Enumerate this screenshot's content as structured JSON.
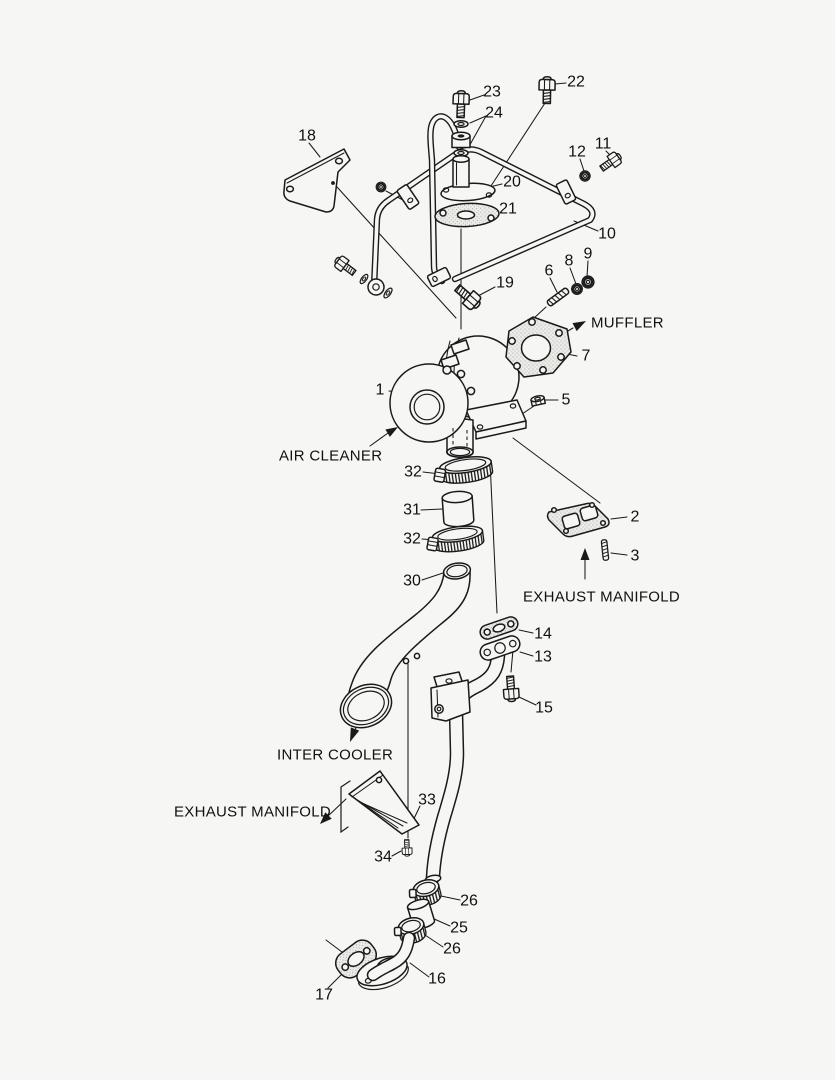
{
  "scene": {
    "background": "#f6f6f5",
    "ink": "#1a1a1a",
    "description": "Exploded parts diagram of a turbocharger with oil lines, intercooler pipe and oil drain piping"
  },
  "callouts": [
    {
      "part": "23",
      "x": 492,
      "y": 92
    },
    {
      "part": "22",
      "x": 576,
      "y": 82
    },
    {
      "part": "24",
      "x": 494,
      "y": 113
    },
    {
      "part": "18",
      "x": 307,
      "y": 136
    },
    {
      "part": "11",
      "x": 603,
      "y": 144
    },
    {
      "part": "12",
      "x": 577,
      "y": 152
    },
    {
      "part": "20",
      "x": 512,
      "y": 182
    },
    {
      "part": "21",
      "x": 508,
      "y": 209
    },
    {
      "part": "10",
      "x": 607,
      "y": 234
    },
    {
      "part": "9",
      "x": 588,
      "y": 254
    },
    {
      "part": "8",
      "x": 569,
      "y": 261
    },
    {
      "part": "6",
      "x": 549,
      "y": 271
    },
    {
      "part": "19",
      "x": 505,
      "y": 283
    },
    {
      "part": "7",
      "x": 586,
      "y": 356
    },
    {
      "part": "1",
      "x": 380,
      "y": 390
    },
    {
      "part": "5",
      "x": 566,
      "y": 400
    },
    {
      "part": "32",
      "x": 413,
      "y": 472
    },
    {
      "part": "31",
      "x": 412,
      "y": 510
    },
    {
      "part": "32",
      "x": 412,
      "y": 539
    },
    {
      "part": "30",
      "x": 412,
      "y": 581
    },
    {
      "part": "2",
      "x": 635,
      "y": 517
    },
    {
      "part": "3",
      "x": 635,
      "y": 556
    },
    {
      "part": "14",
      "x": 543,
      "y": 634
    },
    {
      "part": "13",
      "x": 543,
      "y": 657
    },
    {
      "part": "15",
      "x": 544,
      "y": 708
    },
    {
      "part": "33",
      "x": 427,
      "y": 800
    },
    {
      "part": "34",
      "x": 383,
      "y": 857
    },
    {
      "part": "26",
      "x": 469,
      "y": 901
    },
    {
      "part": "25",
      "x": 459,
      "y": 928
    },
    {
      "part": "26",
      "x": 452,
      "y": 949
    },
    {
      "part": "16",
      "x": 437,
      "y": 979
    },
    {
      "part": "17",
      "x": 324,
      "y": 995
    }
  ],
  "annotations": [
    {
      "id": "muffler",
      "text": "MUFFLER",
      "x": 591,
      "y": 323
    },
    {
      "id": "air-cleaner",
      "text": "AIR CLEANER",
      "x": 279,
      "y": 456
    },
    {
      "id": "exhaust-manifold-upper",
      "text": "EXHAUST MANIFOLD",
      "x": 523,
      "y": 597
    },
    {
      "id": "inter-cooler",
      "text": "INTER COOLER",
      "x": 277,
      "y": 755
    },
    {
      "id": "exhaust-manifold-lower",
      "text": "EXHAUST MANIFOLD",
      "x": 174,
      "y": 812
    }
  ]
}
